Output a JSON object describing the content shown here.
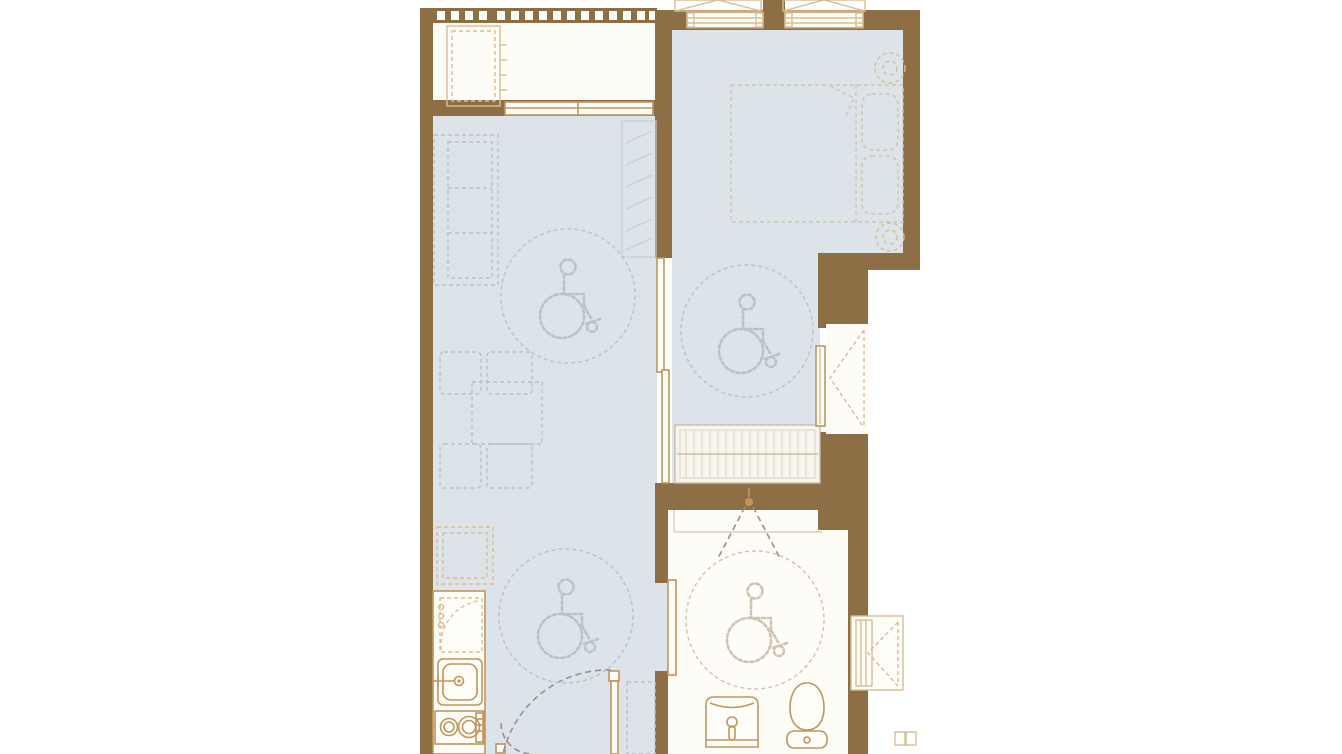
{
  "palette": {
    "background": "#ffffff",
    "wall_brown": "#8d6e45",
    "floor_blue_gray": "#dde4e9",
    "floor_white": "#fdfcf7",
    "fixture_tan": "#c0965e",
    "fixture_tan_light": "#d9bd93",
    "dash_gray_blue": "#b7c2cb",
    "dash_warm_gray": "#cfc3b2",
    "hatch_gray": "#c4cdd4",
    "door_swing_gray": "#9b9186"
  },
  "plan": {
    "type": "apartment-floor-plan",
    "accessibility_turning_circles": 4,
    "accessibility_symbol": "wheelchair-icon",
    "fixtures": [
      "balcony-railing",
      "ac-unit",
      "sliding-window",
      "bedroom-windows",
      "bed",
      "nightstands",
      "wardrobe-with-hangers",
      "sliding-door",
      "sofa",
      "tv-cabinet",
      "dining-table",
      "dining-chairs",
      "refrigerator",
      "kitchen-counter",
      "kitchen-sink",
      "two-burner-stove",
      "entrance-double-door",
      "shoe-cabinet",
      "shower-head",
      "bathroom-sliding-door",
      "wash-basin",
      "toilet",
      "service-shafts"
    ]
  }
}
